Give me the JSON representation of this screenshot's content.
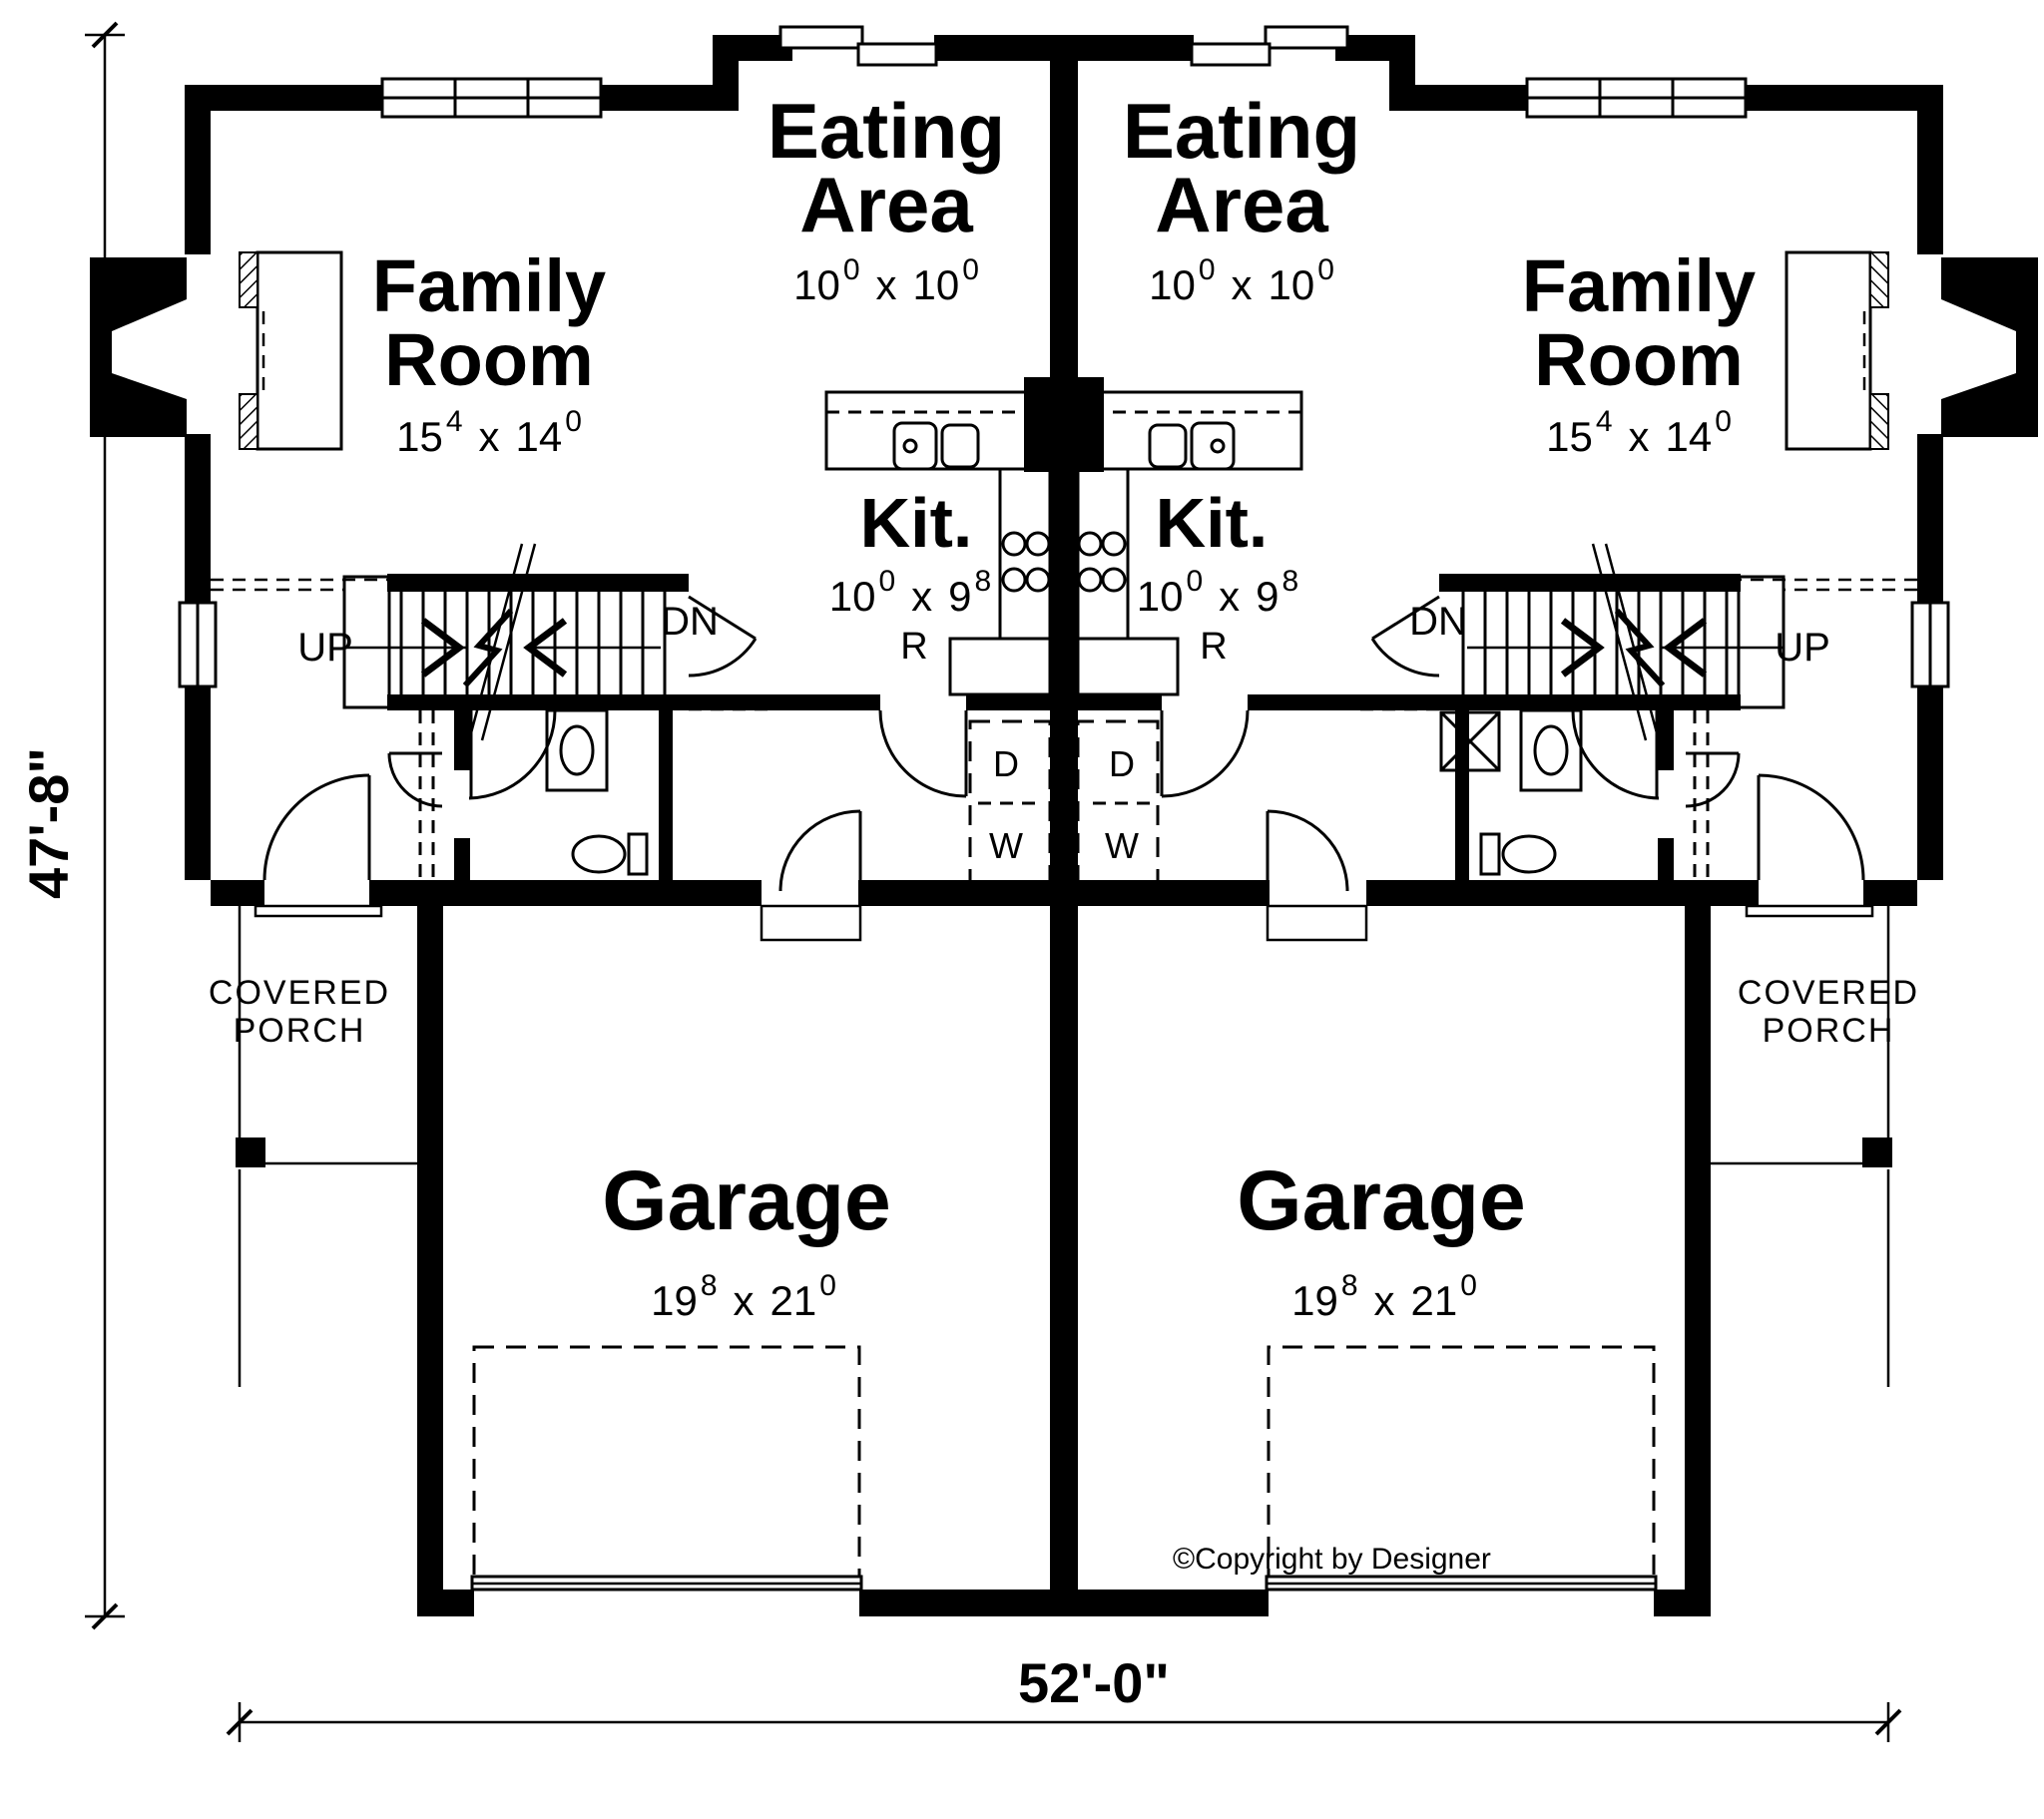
{
  "plan": {
    "overall_width": "52'-0\"",
    "overall_height": "47'-8\"",
    "copyright": "©Copyright by Designer",
    "units": {
      "left": {
        "family_room": {
          "line1": "Family",
          "line2": "Room",
          "size": {
            "w": "15",
            "w_sup": "4",
            "sep": "x",
            "h": "14",
            "h_sup": "0"
          }
        },
        "eating_area": {
          "line1": "Eating",
          "line2": "Area",
          "size": {
            "w": "10",
            "w_sup": "0",
            "sep": "x",
            "h": "10",
            "h_sup": "0"
          }
        },
        "kitchen": {
          "label": "Kit.",
          "size": {
            "w": "10",
            "w_sup": "0",
            "sep": "x",
            "h": "9",
            "h_sup": "8"
          },
          "refrigerator_label": "R"
        },
        "stairs": {
          "up_label": "UP",
          "down_label": "DN"
        },
        "laundry": {
          "dryer_label": "D",
          "washer_label": "W"
        },
        "covered_porch": {
          "line1": "COVERED",
          "line2": "PORCH"
        },
        "garage": {
          "label": "Garage",
          "size": {
            "w": "19",
            "w_sup": "8",
            "sep": "x",
            "h": "21",
            "h_sup": "0"
          }
        }
      },
      "right": {
        "family_room": {
          "line1": "Family",
          "line2": "Room",
          "size": {
            "w": "15",
            "w_sup": "4",
            "sep": "x",
            "h": "14",
            "h_sup": "0"
          }
        },
        "eating_area": {
          "line1": "Eating",
          "line2": "Area",
          "size": {
            "w": "10",
            "w_sup": "0",
            "sep": "x",
            "h": "10",
            "h_sup": "0"
          }
        },
        "kitchen": {
          "label": "Kit.",
          "size": {
            "w": "10",
            "w_sup": "0",
            "sep": "x",
            "h": "9",
            "h_sup": "8"
          },
          "refrigerator_label": "R"
        },
        "stairs": {
          "up_label": "UP",
          "down_label": "DN"
        },
        "laundry": {
          "dryer_label": "D",
          "washer_label": "W"
        },
        "covered_porch": {
          "line1": "COVERED",
          "line2": "PORCH"
        },
        "garage": {
          "label": "Garage",
          "size": {
            "w": "19",
            "w_sup": "8",
            "sep": "x",
            "h": "21",
            "h_sup": "0"
          }
        }
      }
    }
  }
}
